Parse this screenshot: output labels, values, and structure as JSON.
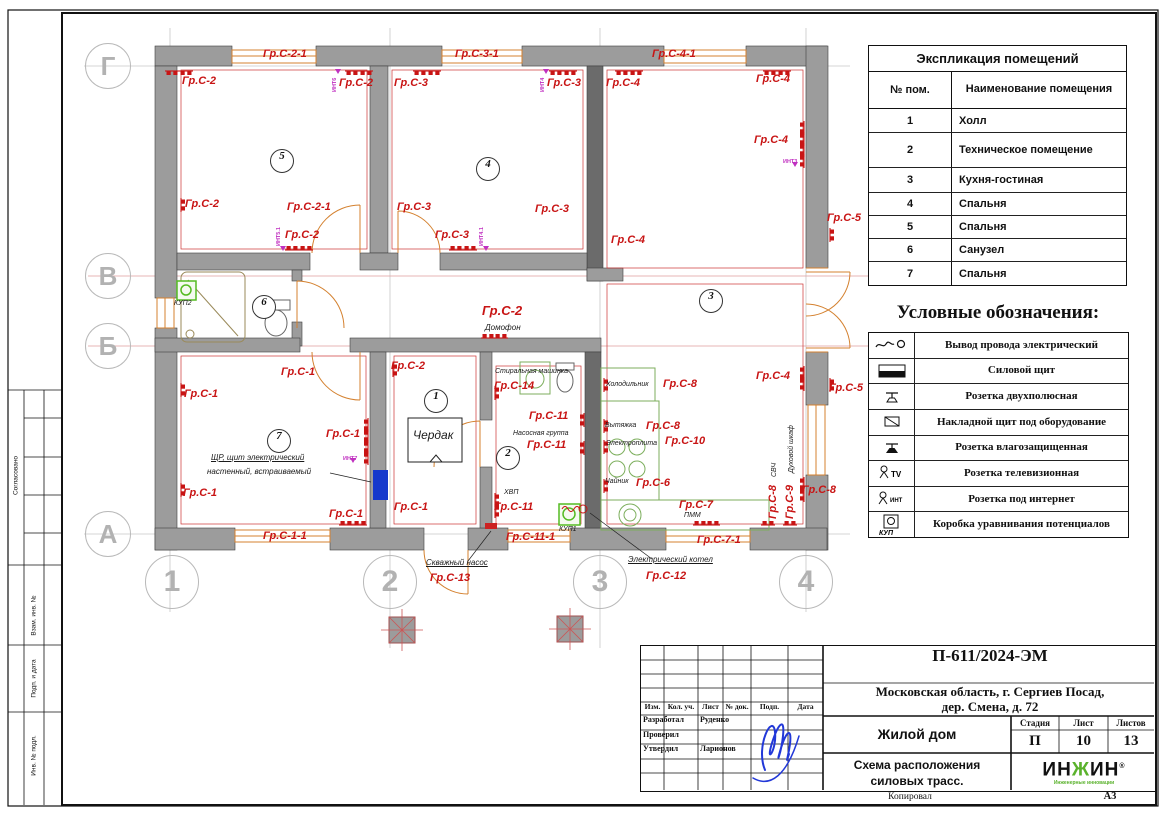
{
  "sheet": {
    "format": "А3",
    "copied_by": "Копировал"
  },
  "side_strip": {
    "agreed": "Согласовано",
    "vzam": "Взам. инв. №",
    "podp_data": "Подп. и дата",
    "inv_podl": "Инв. № подл."
  },
  "explication": {
    "title": "Экспликация помещений",
    "col1": "№ пом.",
    "col2": "Наименование помещения",
    "rows": [
      [
        "1",
        "Холл"
      ],
      [
        "2",
        "Техническое помещение"
      ],
      [
        "3",
        "Кухня-гостиная"
      ],
      [
        "4",
        "Спальня"
      ],
      [
        "5",
        "Спальня"
      ],
      [
        "6",
        "Санузел"
      ],
      [
        "7",
        "Спальня"
      ]
    ]
  },
  "legend": {
    "title": "Условные обозначения:",
    "items": [
      {
        "icon": "wire-exit",
        "label": "Вывод провода электрический"
      },
      {
        "icon": "power-panel",
        "label": "Силовой щит"
      },
      {
        "icon": "socket-2p",
        "label": "Розетка двухполюсная"
      },
      {
        "icon": "surface-panel",
        "label": "Накладной щит под оборудование"
      },
      {
        "icon": "socket-wp",
        "label": "Розетка влагозащищенная"
      },
      {
        "icon": "socket-tv",
        "icon_text": "TV",
        "label": "Розетка телевизионная"
      },
      {
        "icon": "socket-int",
        "icon_text": "ИНТ",
        "label": "Розетка под интернет"
      },
      {
        "icon": "kup-box",
        "icon_text": "КУП",
        "label": "Коробка уравнивания потенциалов"
      }
    ]
  },
  "title_block": {
    "doc_number": "П-611/2024-ЭМ",
    "address_line1": "Московская область, г. Сергиев Посад,",
    "address_line2": "дер. Смена, д. 72",
    "object_name": "Жилой дом",
    "drawing_title_line1": "Схема расположения",
    "drawing_title_line2": "силовых трасс.",
    "stage_label": "Стадия",
    "sheet_label": "Лист",
    "sheets_label": "Листов",
    "stage": "П",
    "sheet": "10",
    "sheets": "13",
    "cols": [
      "Изм.",
      "Кол. уч.",
      "Лист",
      "№ док.",
      "Подп.",
      "Дата"
    ],
    "roles": [
      {
        "role": "Разработал",
        "name": "Руденко"
      },
      {
        "role": "Проверил",
        "name": ""
      },
      {
        "role": "Утвердил",
        "name": "Ларионов"
      }
    ],
    "logo_text": "ИНЖИН",
    "logo_r": "®",
    "logo_tagline": "Инженерные инновации"
  },
  "colors": {
    "group_label": "#c81414",
    "int_label": "#c030c0",
    "wall": "#9c9c9c",
    "door": "#d4812f",
    "kitchen": "#7cae5c",
    "kup": "#55bb22",
    "panel_blue": "#1538cc",
    "signature_blue": "#2238d8",
    "logo_green": "#5ab22c"
  },
  "plan": {
    "axis_rows": [
      {
        "l": "Г",
        "x": 108,
        "y": 66
      },
      {
        "l": "В",
        "x": 108,
        "y": 276
      },
      {
        "l": "Б",
        "x": 108,
        "y": 346
      },
      {
        "l": "А",
        "x": 108,
        "y": 534
      }
    ],
    "axis_cols": [
      {
        "l": "1",
        "x": 172,
        "y": 582
      },
      {
        "l": "2",
        "x": 390,
        "y": 582
      },
      {
        "l": "3",
        "x": 600,
        "y": 582
      },
      {
        "l": "4",
        "x": 806,
        "y": 582
      }
    ],
    "rooms": [
      {
        "n": "5",
        "x": 281,
        "y": 160
      },
      {
        "n": "4",
        "x": 487,
        "y": 168
      },
      {
        "n": "3",
        "x": 710,
        "y": 300
      },
      {
        "n": "6",
        "x": 263,
        "y": 306
      },
      {
        "n": "1",
        "x": 435,
        "y": 400
      },
      {
        "n": "2",
        "x": 507,
        "y": 457
      },
      {
        "n": "7",
        "x": 278,
        "y": 440
      }
    ],
    "group_labels": [
      {
        "t": "Гр.С-2-1",
        "x": 263,
        "y": 49
      },
      {
        "t": "Гр.С-2",
        "x": 182,
        "y": 76
      },
      {
        "t": "Гр.С-2",
        "x": 339,
        "y": 78
      },
      {
        "t": "Гр.С-3-1",
        "x": 455,
        "y": 49
      },
      {
        "t": "Гр.С-3",
        "x": 394,
        "y": 78
      },
      {
        "t": "Гр.С-3",
        "x": 547,
        "y": 78
      },
      {
        "t": "Гр.С-4",
        "x": 606,
        "y": 78
      },
      {
        "t": "Гр.С-4-1",
        "x": 652,
        "y": 49
      },
      {
        "t": "Гр.С-4",
        "x": 756,
        "y": 74
      },
      {
        "t": "Гр.С-2",
        "x": 185,
        "y": 199
      },
      {
        "t": "Гр.С-2-1",
        "x": 287,
        "y": 202
      },
      {
        "t": "Гр.С-3",
        "x": 397,
        "y": 202
      },
      {
        "t": "Гр.С-2",
        "x": 285,
        "y": 230
      },
      {
        "t": "Гр.С-3",
        "x": 435,
        "y": 230
      },
      {
        "t": "Гр.С-3",
        "x": 535,
        "y": 204
      },
      {
        "t": "Гр.С-4",
        "x": 611,
        "y": 235
      },
      {
        "t": "Гр.С-4",
        "x": 754,
        "y": 135
      },
      {
        "t": "Гр.С-5",
        "x": 827,
        "y": 213
      },
      {
        "t": "Гр.С-4",
        "x": 756,
        "y": 371
      },
      {
        "t": "Гр.С-5",
        "x": 829,
        "y": 383
      },
      {
        "t": "Гр.С-1",
        "x": 281,
        "y": 367
      },
      {
        "t": "Гр.С-1",
        "x": 184,
        "y": 389
      },
      {
        "t": "Гр.С-1",
        "x": 326,
        "y": 429
      },
      {
        "t": "Гр.С-1",
        "x": 183,
        "y": 488
      },
      {
        "t": "Гр.С-1",
        "x": 329,
        "y": 509
      },
      {
        "t": "Гр.С-1-1",
        "x": 263,
        "y": 531
      },
      {
        "t": "Гр.С-1",
        "x": 394,
        "y": 502
      },
      {
        "t": "Гр.С-2",
        "x": 391,
        "y": 361
      },
      {
        "t": "Гр.С-2",
        "x": 482,
        "y": 304,
        "s": 13
      },
      {
        "t": "Гр.С-14",
        "x": 494,
        "y": 381
      },
      {
        "t": "Гр.С-11",
        "x": 529,
        "y": 411
      },
      {
        "t": "Гр.С-11",
        "x": 527,
        "y": 440
      },
      {
        "t": "Гр.С-11",
        "x": 494,
        "y": 502
      },
      {
        "t": "Гр.С-11-1",
        "x": 506,
        "y": 532
      },
      {
        "t": "Гр.С-13",
        "x": 430,
        "y": 573
      },
      {
        "t": "Гр.С-12",
        "x": 646,
        "y": 571
      },
      {
        "t": "Гр.С-8",
        "x": 663,
        "y": 379
      },
      {
        "t": "Гр.С-8",
        "x": 646,
        "y": 421
      },
      {
        "t": "Гр.С-10",
        "x": 665,
        "y": 436
      },
      {
        "t": "Гр.С-6",
        "x": 636,
        "y": 478
      },
      {
        "t": "Гр.С-7",
        "x": 679,
        "y": 500
      },
      {
        "t": "Гр.С-7-1",
        "x": 697,
        "y": 535
      },
      {
        "t": "Гр.С-8",
        "x": 802,
        "y": 485
      },
      {
        "t": "Гр.С-8",
        "x": 768,
        "y": 519,
        "r": -90
      },
      {
        "t": "Гр.С-9",
        "x": 785,
        "y": 519,
        "r": -90
      }
    ],
    "device_labels": [
      {
        "t": "Домофон",
        "x": 485,
        "y": 324,
        "s": 8
      },
      {
        "t": "Стиральная машинка",
        "x": 495,
        "y": 368,
        "s": 7
      },
      {
        "t": "Насосная группа",
        "x": 513,
        "y": 430,
        "s": 7
      },
      {
        "t": "ХВП",
        "x": 504,
        "y": 489,
        "s": 7
      },
      {
        "t": "Скважный насос",
        "x": 426,
        "y": 559,
        "s": 8,
        "u": true
      },
      {
        "t": "Электрический котел",
        "x": 628,
        "y": 556,
        "s": 8,
        "u": true
      },
      {
        "t": "Холодильник",
        "x": 606,
        "y": 381,
        "s": 7
      },
      {
        "t": "Вытяжка",
        "x": 605,
        "y": 422,
        "s": 7
      },
      {
        "t": "Электроплита",
        "x": 606,
        "y": 440,
        "s": 7
      },
      {
        "t": "Чайник",
        "x": 605,
        "y": 478,
        "s": 7
      },
      {
        "t": "ПММ",
        "x": 684,
        "y": 512,
        "s": 7
      },
      {
        "t": "СВЧ",
        "x": 771,
        "y": 477,
        "s": 7,
        "r": -90
      },
      {
        "t": "Духовой шкаф",
        "x": 788,
        "y": 473,
        "s": 7,
        "r": -90
      },
      {
        "t": "КУП2",
        "x": 174,
        "y": 300,
        "s": 7
      },
      {
        "t": "КУП1",
        "x": 559,
        "y": 526,
        "s": 7
      },
      {
        "t": "ЩР, щит электрический",
        "x": 211,
        "y": 454,
        "s": 8,
        "u": true
      },
      {
        "t": "настенный, встраиваемый",
        "x": 207,
        "y": 468,
        "s": 8
      },
      {
        "t": "Чердак",
        "x": 413,
        "y": 429,
        "s": 12
      }
    ],
    "int_labels": [
      {
        "t": "ИНТ6",
        "x": 333,
        "y": 92,
        "r": -90
      },
      {
        "t": "ИНТ4",
        "x": 541,
        "y": 92,
        "r": -90
      },
      {
        "t": "ИНТ3",
        "x": 783,
        "y": 160
      },
      {
        "t": "ИНТ5.1",
        "x": 277,
        "y": 246,
        "r": -90
      },
      {
        "t": "ИНТ4.1",
        "x": 480,
        "y": 246,
        "r": -90
      },
      {
        "t": "ИНТ7",
        "x": 343,
        "y": 457
      }
    ],
    "sockets": [
      {
        "x": 172,
        "y": 71,
        "r": 180
      },
      {
        "x": 186,
        "y": 71,
        "r": 180
      },
      {
        "x": 352,
        "y": 71,
        "r": 180
      },
      {
        "x": 366,
        "y": 71,
        "r": 180
      },
      {
        "x": 420,
        "y": 71,
        "r": 180
      },
      {
        "x": 434,
        "y": 71,
        "r": 180
      },
      {
        "x": 556,
        "y": 71,
        "r": 180
      },
      {
        "x": 570,
        "y": 71,
        "r": 180
      },
      {
        "x": 622,
        "y": 71,
        "r": 180
      },
      {
        "x": 636,
        "y": 71,
        "r": 180
      },
      {
        "x": 770,
        "y": 71,
        "r": 180
      },
      {
        "x": 784,
        "y": 71,
        "r": 180
      },
      {
        "x": 292,
        "y": 250,
        "r": 0
      },
      {
        "x": 306,
        "y": 250,
        "r": 0
      },
      {
        "x": 456,
        "y": 250,
        "r": 0
      },
      {
        "x": 470,
        "y": 250,
        "r": 0
      },
      {
        "x": 488,
        "y": 338,
        "r": 0
      },
      {
        "x": 501,
        "y": 338,
        "r": 0
      },
      {
        "x": 181,
        "y": 205,
        "r": 90
      },
      {
        "x": 181,
        "y": 390,
        "r": 90
      },
      {
        "x": 181,
        "y": 490,
        "r": 90
      },
      {
        "x": 368,
        "y": 425,
        "r": 270
      },
      {
        "x": 368,
        "y": 436,
        "r": 270
      },
      {
        "x": 368,
        "y": 447,
        "r": 270
      },
      {
        "x": 368,
        "y": 458,
        "r": 270
      },
      {
        "x": 346,
        "y": 525,
        "r": 0
      },
      {
        "x": 360,
        "y": 525,
        "r": 0
      },
      {
        "x": 393,
        "y": 370,
        "r": 90
      },
      {
        "x": 495,
        "y": 393,
        "r": 90
      },
      {
        "x": 495,
        "y": 500,
        "r": 90
      },
      {
        "x": 495,
        "y": 511,
        "r": 90
      },
      {
        "x": 584,
        "y": 420,
        "r": 270
      },
      {
        "x": 584,
        "y": 448,
        "r": 270
      },
      {
        "x": 604,
        "y": 385,
        "r": 90
      },
      {
        "x": 604,
        "y": 426,
        "r": 90
      },
      {
        "x": 604,
        "y": 447,
        "r": 90
      },
      {
        "x": 604,
        "y": 486,
        "r": 90
      },
      {
        "x": 700,
        "y": 525,
        "r": 0
      },
      {
        "x": 713,
        "y": 525,
        "r": 0
      },
      {
        "x": 768,
        "y": 525,
        "r": 0
      },
      {
        "x": 790,
        "y": 525,
        "r": 0
      },
      {
        "x": 804,
        "y": 128,
        "r": 270
      },
      {
        "x": 804,
        "y": 139,
        "r": 270
      },
      {
        "x": 804,
        "y": 150,
        "r": 270
      },
      {
        "x": 804,
        "y": 161,
        "r": 270
      },
      {
        "x": 804,
        "y": 373,
        "r": 270
      },
      {
        "x": 804,
        "y": 384,
        "r": 270
      },
      {
        "x": 804,
        "y": 484,
        "r": 270
      },
      {
        "x": 804,
        "y": 495,
        "r": 270
      },
      {
        "x": 830,
        "y": 235,
        "r": 90
      },
      {
        "x": 830,
        "y": 385,
        "r": 90
      }
    ]
  }
}
